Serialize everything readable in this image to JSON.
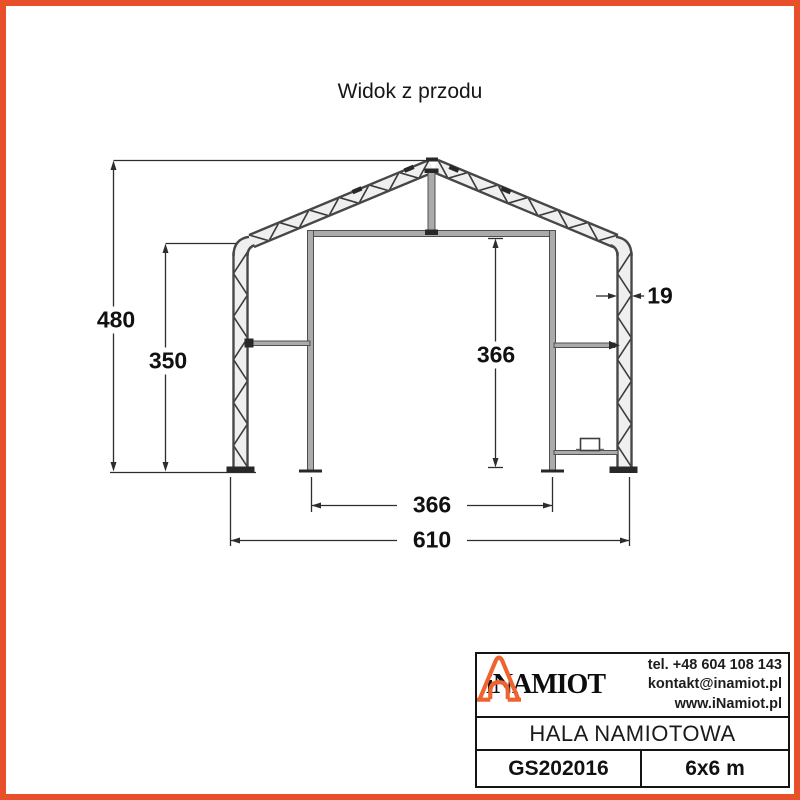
{
  "colors": {
    "accent": "#E8502B",
    "icon_orange": "#EE6330",
    "line": "#2d2d2d"
  },
  "page": {
    "title": "Widok z przodu"
  },
  "dimensions": {
    "total_height": "480",
    "side_wall_height": "350",
    "door_clear_height": "366",
    "frame_thickness": "19",
    "door_clear_width": "366",
    "total_width": "610"
  },
  "title_block": {
    "brand": "iNAMIOT",
    "contact": {
      "phone": "tel. +48 604 108 143",
      "email": "kontakt@inamiot.pl",
      "website": "www.iNamiot.pl"
    },
    "product_name": "HALA NAMIOTOWA",
    "model": "GS202016",
    "size": "6x6 m"
  }
}
